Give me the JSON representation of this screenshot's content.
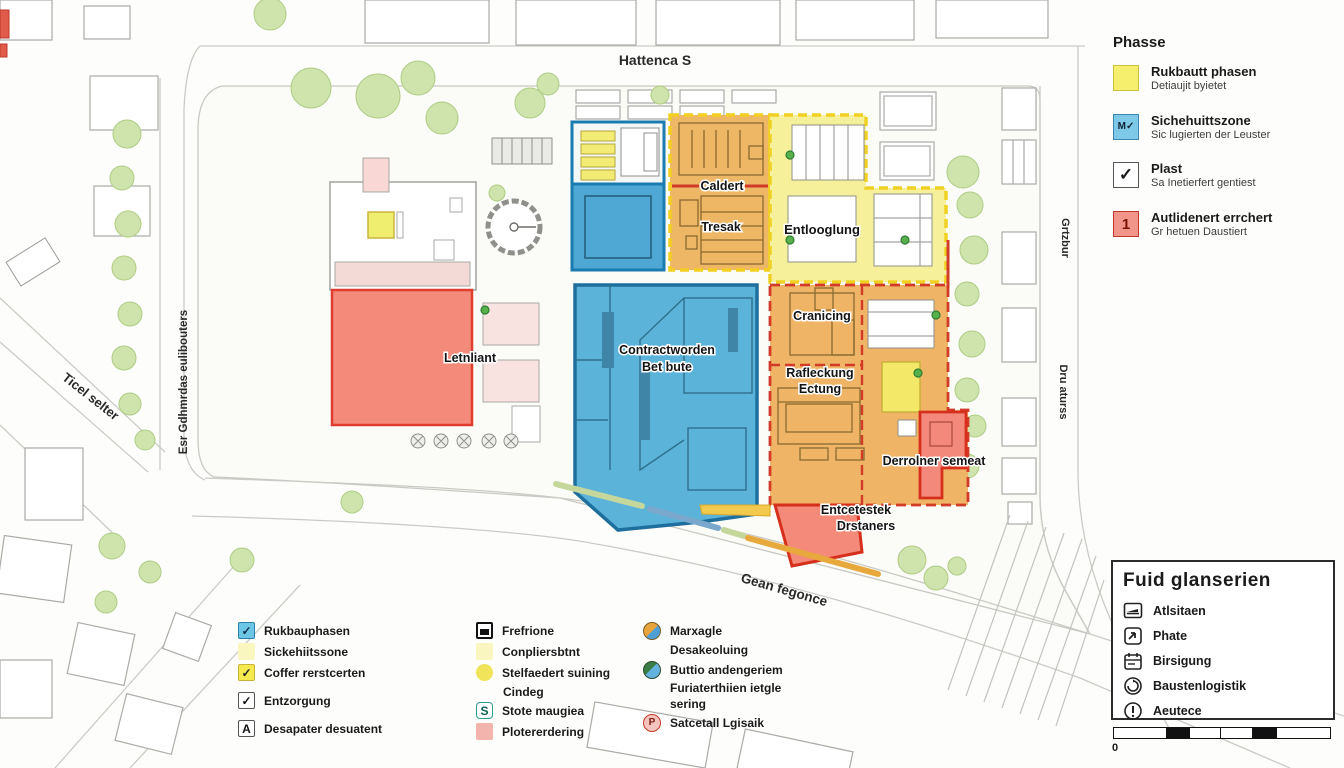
{
  "map": {
    "streets": {
      "top": "Hattenca S",
      "left_vertical": "Esr Gdhmrdas eulibouters",
      "left_diagonal": "Ticel selter",
      "right_top_vertical": "Grtzbur",
      "right_bottom_vertical": "Dru aturss",
      "bottom_diagonal": "Gean fegonce"
    },
    "zones": {
      "caldert": "Caldert",
      "tresak": "Tresak",
      "entlooglung": "Entlooglung",
      "cranicing": "Cranicing",
      "contract_line1": "Contractworden",
      "contract_line2": "Bet bute",
      "letnliant": "Letnliant",
      "rafleckung_line1": "Rafleckung",
      "rafleckung_line2": "Ectung",
      "derrolner": "Derrolner semeat",
      "entcetestek_line1": "Entcetestek",
      "entcetestek_line2": "Drstaners"
    }
  },
  "phase_legend": {
    "title": "Phasse",
    "items": [
      {
        "glyph": "",
        "label": "Rukbautt phasen",
        "sublabel": "Detiaujit byietet"
      },
      {
        "glyph": "M✓",
        "label": "Sichehuittszone",
        "sublabel": "Sic lugierten der Leuster"
      },
      {
        "glyph": "✓",
        "label": "Plast",
        "sublabel": "Sa Inetierfert gentiest"
      },
      {
        "glyph": "1",
        "label": "Autlidenert errchert",
        "sublabel": "Gr hetuen Daustiert"
      }
    ],
    "colors": {
      "yellow": "#f5ef6d",
      "blue": "#7ec8e8",
      "white": "#ffffff",
      "red": "#f1948a"
    }
  },
  "bottom_legend": {
    "col1": [
      {
        "label": "Rukbauphasen"
      },
      {
        "label": "Sickehiitssone"
      },
      {
        "label": "Coffer rerstcerten"
      },
      {
        "label": "Entzorgung"
      },
      {
        "label": "Desapater desuatent",
        "glyph": "A"
      }
    ],
    "col2": [
      {
        "label": "Frefrione"
      },
      {
        "label": "Conpliersbtnt"
      },
      {
        "label": "Stelfaedert suining",
        "label2": "Cindeg"
      },
      {
        "label": "Stote maugiea",
        "glyph": "S"
      },
      {
        "label": "Plotererdering"
      }
    ],
    "col3": [
      {
        "label": "Marxagle"
      },
      {
        "label": "Desakeoluing"
      },
      {
        "label": "Buttio andengeriem"
      },
      {
        "label": "Furiaterthiien ietgle",
        "label2": "sering"
      },
      {
        "label": "Satcetall Lgisaik",
        "glyph": "P"
      }
    ]
  },
  "info_box": {
    "title": "Fuid glanserien",
    "items": [
      {
        "label": "Atlsitaen"
      },
      {
        "label": "Phate"
      },
      {
        "label": "Birsigung"
      },
      {
        "label": "Baustenlogistik"
      },
      {
        "label": "Aeutece"
      }
    ],
    "scale_zero": "0"
  }
}
